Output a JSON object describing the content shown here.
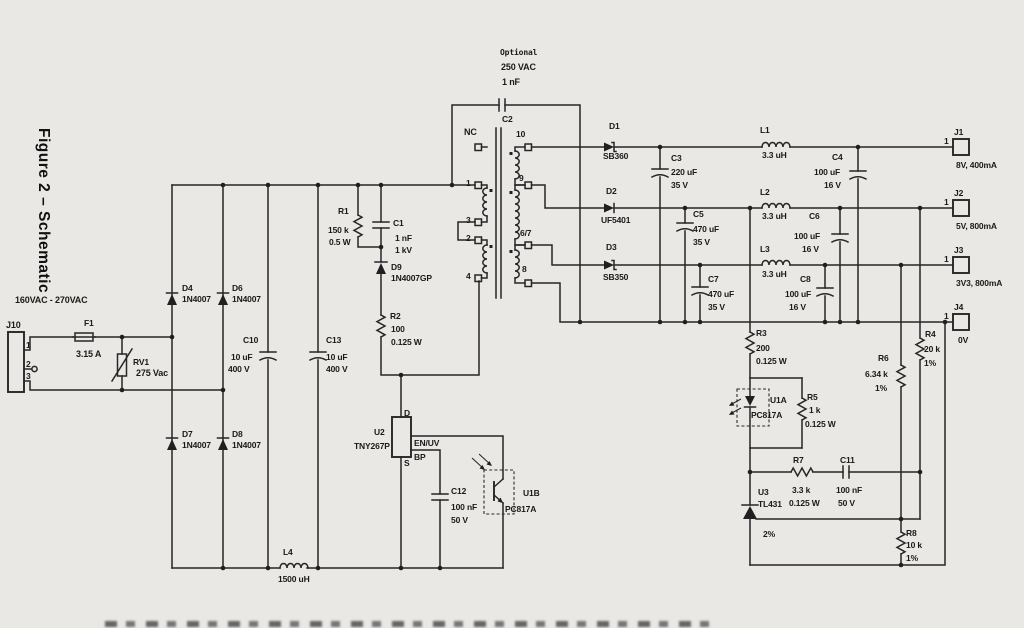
{
  "figure": {
    "title": "Figure 2 – Schematic",
    "input_range": "160VAC - 270VAC"
  },
  "input": {
    "connector": {
      "ref": "J10",
      "pins": [
        "1",
        "2",
        "3"
      ]
    },
    "fuse": {
      "ref": "F1",
      "value": "3.15 A"
    },
    "varistor": {
      "ref": "RV1",
      "value": "275 Vac"
    }
  },
  "bridge": {
    "d4": {
      "ref": "D4",
      "part": "1N4007"
    },
    "d6": {
      "ref": "D6",
      "part": "1N4007"
    },
    "d7": {
      "ref": "D7",
      "part": "1N4007"
    },
    "d8": {
      "ref": "D8",
      "part": "1N4007"
    }
  },
  "bus_filter": {
    "c10": {
      "ref": "C10",
      "value": "10 uF",
      "rating": "400 V"
    },
    "c13": {
      "ref": "C13",
      "value": "10 uF",
      "rating": "400 V"
    },
    "l4": {
      "ref": "L4",
      "value": "1500 uH"
    }
  },
  "clamp": {
    "r1": {
      "ref": "R1",
      "value": "150 k",
      "rating": "0.5 W"
    },
    "c1": {
      "ref": "C1",
      "value": "1 nF",
      "rating": "1 kV"
    },
    "d9": {
      "ref": "D9",
      "part": "1N4007GP"
    },
    "r2": {
      "ref": "R2",
      "value": "100",
      "rating": "0.125 W"
    }
  },
  "transformer": {
    "y_cap": {
      "ref": "C2",
      "note": "Optional",
      "rating": "250 VAC",
      "value": "1 nF"
    },
    "nc_label": "NC",
    "primary_pins": [
      "1",
      "3",
      "2",
      "4"
    ],
    "secondary_pins": [
      "10",
      "9",
      "6/7",
      "8"
    ]
  },
  "switcher": {
    "ref": "U2",
    "part": "TNY267P",
    "pin_drain": "D",
    "pin_source": "S",
    "pin_enable": "EN/UV",
    "pin_bypass": "BP"
  },
  "bypass_cap": {
    "ref": "C12",
    "value": "100 nF",
    "rating": "50 V"
  },
  "opto": {
    "receiver": {
      "ref": "U1B",
      "part": "PC817A"
    },
    "emitter": {
      "ref": "U1A",
      "part": "PC817A"
    }
  },
  "outputs": [
    {
      "diode": {
        "ref": "D1",
        "part": "SB360"
      },
      "filter_cap": {
        "ref": "C3",
        "value": "220 uF",
        "rating": "35 V"
      },
      "inductor": {
        "ref": "L1",
        "value": "3.3 uH"
      },
      "output_cap": {
        "ref": "C4",
        "value": "100 uF",
        "rating": "16 V"
      },
      "connector": {
        "ref": "J1",
        "pin": "1"
      },
      "label": "8V, 400mA"
    },
    {
      "diode": {
        "ref": "D2",
        "part": "UF5401"
      },
      "filter_cap": {
        "ref": "C5",
        "value": "470 uF",
        "rating": "35 V"
      },
      "inductor": {
        "ref": "L2",
        "value": "3.3 uH"
      },
      "output_cap": {
        "ref": "C6",
        "value": "100 uF",
        "rating": "16 V"
      },
      "connector": {
        "ref": "J2",
        "pin": "1"
      },
      "label": "5V, 800mA"
    },
    {
      "diode": {
        "ref": "D3",
        "part": "SB350"
      },
      "filter_cap": {
        "ref": "C7",
        "value": "470 uF",
        "rating": "35 V"
      },
      "inductor": {
        "ref": "L3",
        "value": "3.3 uH"
      },
      "output_cap": {
        "ref": "C8",
        "value": "100 uF",
        "rating": "16 V"
      },
      "connector": {
        "ref": "J3",
        "pin": "1"
      },
      "label": "3V3, 800mA"
    }
  ],
  "return_output": {
    "connector": {
      "ref": "J4",
      "pin": "1"
    },
    "label": "0V"
  },
  "feedback": {
    "r3": {
      "ref": "R3",
      "value": "200",
      "rating": "0.125 W"
    },
    "r4": {
      "ref": "R4",
      "value": "20 k",
      "rating": "1%"
    },
    "r5": {
      "ref": "R5",
      "value": "1 k",
      "rating": "0.125 W"
    },
    "r6": {
      "ref": "R6",
      "value": "6.34 k",
      "rating": "1%"
    },
    "r7": {
      "ref": "R7",
      "value": "3.3 k",
      "rating": "0.125 W"
    },
    "r8": {
      "ref": "R8",
      "value": "10 k",
      "rating": "1%"
    },
    "c11": {
      "ref": "C11",
      "value": "100 nF",
      "rating": "50 V"
    },
    "shunt": {
      "ref": "U3",
      "part": "TL431",
      "tolerance": "2%"
    }
  },
  "colors": {
    "background": "#e9e8e5",
    "ink": "#262626"
  }
}
